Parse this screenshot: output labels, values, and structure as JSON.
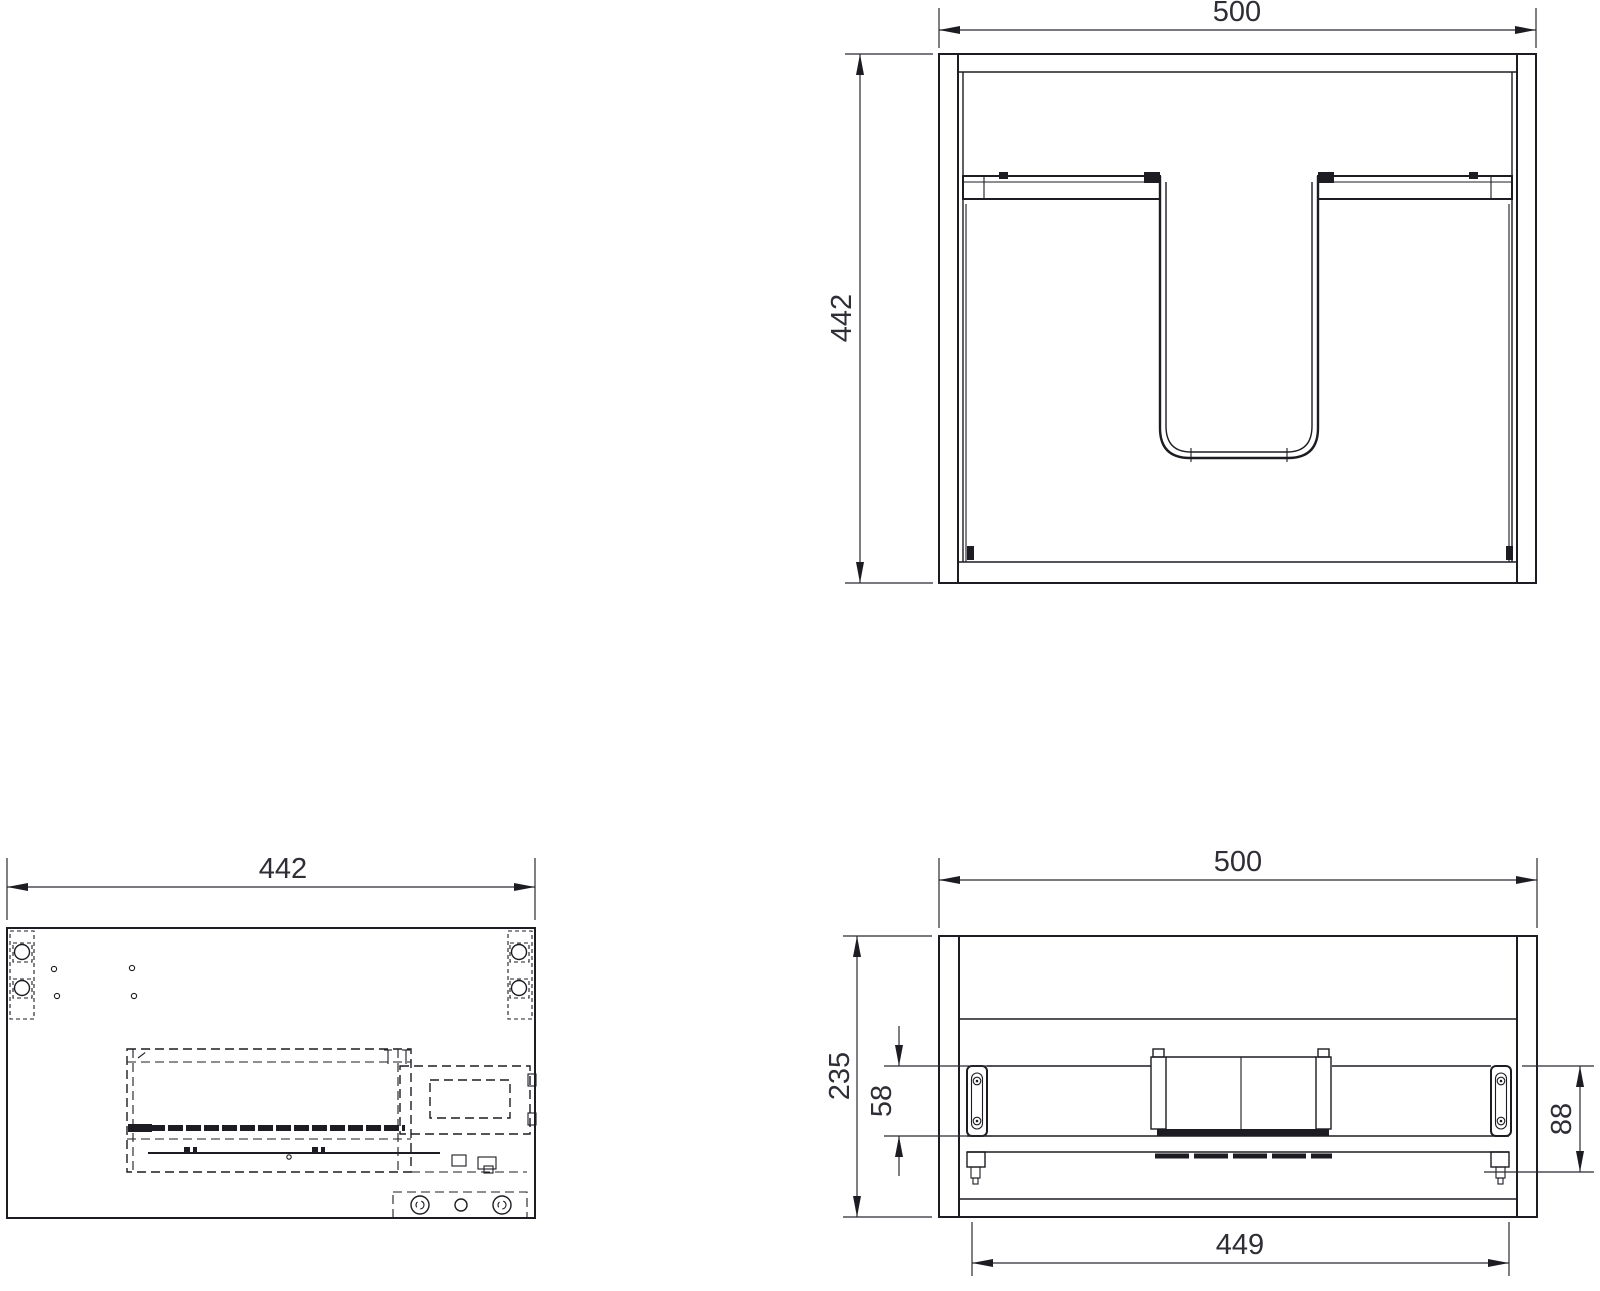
{
  "drawing": {
    "background": "#ffffff",
    "line_color": "#1c1c22",
    "text_color": "#2e2e36",
    "views": {
      "front_view": {
        "label": "front-view",
        "width_dim": "500",
        "height_dim": "442"
      },
      "side_view": {
        "label": "side-view",
        "length_dim": "442"
      },
      "bottom_view": {
        "label": "bottom-view",
        "width_dim": "500",
        "depth_dim": "235",
        "bracket_dim": "58",
        "clearance_dim": "88",
        "span_dim": "449"
      }
    }
  }
}
